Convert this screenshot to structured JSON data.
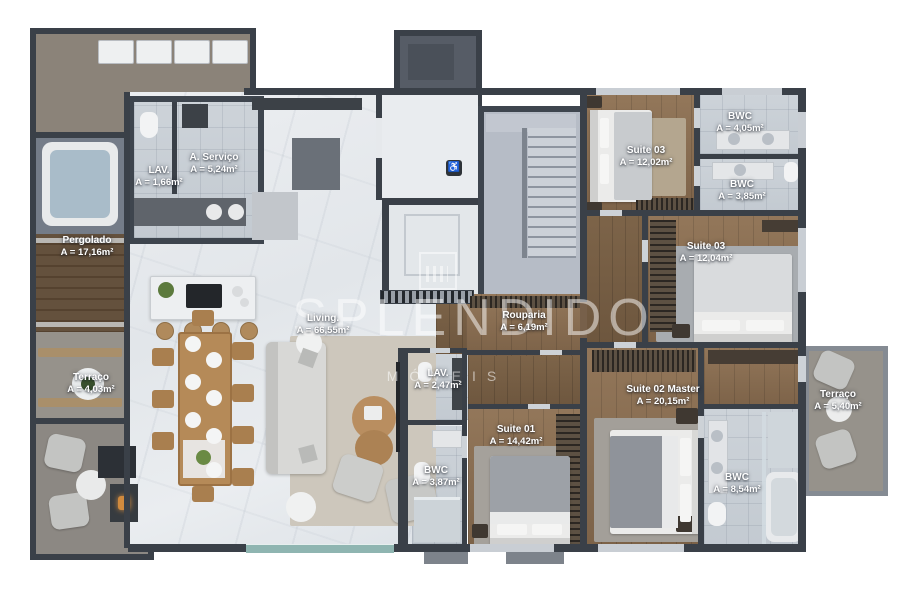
{
  "title": "Apartment floor plan (3D render)",
  "watermark": {
    "brand": "SPLENDIDO",
    "subtitle": "MÓVEIS"
  },
  "icons": {
    "elevator_sign": "♿"
  },
  "colors": {
    "wall": "#3a4048",
    "wood_floor": "#8a6e4f",
    "marble_floor": "#e6e9ec",
    "tile_floor": "#c9cfd6",
    "deck": "#5a4636",
    "label_text": "#ffffff"
  },
  "rooms": {
    "lav_social": {
      "name": "LAV.",
      "area": "A = 1,66m²"
    },
    "servico": {
      "name": "A. Serviço",
      "area": "A = 5,24m²"
    },
    "pergolado": {
      "name": "Pergolado",
      "area": "A = 17,16m²"
    },
    "terraco_esq": {
      "name": "Terraço",
      "area": "A = 4,03m²"
    },
    "living": {
      "name": "Living.",
      "area": "A = 66,55m²"
    },
    "rouparia": {
      "name": "Rouparia",
      "area": "A = 6,19m²"
    },
    "lav_intimo": {
      "name": "LAV.",
      "area": "A = 2,47m²"
    },
    "suite03_a": {
      "name": "Suite 03",
      "area": "A = 12,02m²"
    },
    "bwc_suite03_a": {
      "name": "BWC",
      "area": "A = 4,05m²"
    },
    "bwc_suite03_b": {
      "name": "BWC",
      "area": "A = 3,85m²"
    },
    "suite03_b": {
      "name": "Suite 03",
      "area": "A = 12,04m²"
    },
    "suite02_master": {
      "name": "Suite 02 Master",
      "area": "A = 20,15m²"
    },
    "terraco_dir": {
      "name": "Terraço",
      "area": "A = 5,40m²"
    },
    "suite01": {
      "name": "Suite 01",
      "area": "A = 14,42m²"
    },
    "bwc_suite01": {
      "name": "BWC",
      "area": "A = 3,87m²"
    },
    "bwc_master": {
      "name": "BWC",
      "area": "A = 8,54m²"
    }
  }
}
